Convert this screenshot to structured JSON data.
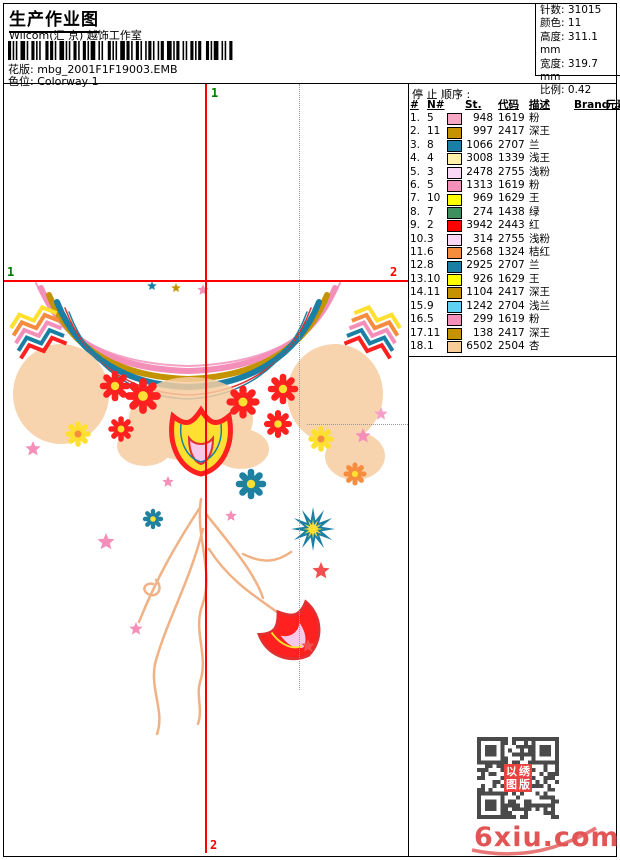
{
  "header": {
    "title": "生产作业图",
    "subtitle": "Wilcom(汇 京) 越饰工作室",
    "design_label": "花版:",
    "design_value": "mbg_2001F1F19003.EMB",
    "colorway_label": "色位:",
    "colorway_value": "Colorway 1"
  },
  "info_box": {
    "rows": [
      {
        "label": "针数:",
        "value": "31015"
      },
      {
        "label": "颜色:",
        "value": "11"
      },
      {
        "label": "高度:",
        "value": "311.1 mm"
      },
      {
        "label": "宽度:",
        "value": "319.7 mm"
      },
      {
        "label": "比例:",
        "value": "0.42"
      }
    ]
  },
  "stop_sequence": {
    "title": "停 止 顺序 :",
    "columns": [
      "#",
      "N#",
      "St.",
      "代码",
      "描述",
      "Brand",
      "元素"
    ],
    "rows": [
      {
        "idx": "1.",
        "needle": "5",
        "color": "#F7A8C4",
        "st": "948",
        "code": "1619",
        "desc": "粉"
      },
      {
        "idx": "2.",
        "needle": "11",
        "color": "#C49300",
        "st": "997",
        "code": "2417",
        "desc": "深王"
      },
      {
        "idx": "3.",
        "needle": "8",
        "color": "#1B7FA4",
        "st": "1066",
        "code": "2707",
        "desc": "兰"
      },
      {
        "idx": "4.",
        "needle": "4",
        "color": "#FFF2A8",
        "st": "3008",
        "code": "1339",
        "desc": "浅王"
      },
      {
        "idx": "5.",
        "needle": "3",
        "color": "#FAD7F5",
        "st": "2478",
        "code": "2755",
        "desc": "浅粉"
      },
      {
        "idx": "6.",
        "needle": "5",
        "color": "#F48FB9",
        "st": "1313",
        "code": "1619",
        "desc": "粉"
      },
      {
        "idx": "7.",
        "needle": "10",
        "color": "#FFFF00",
        "st": "969",
        "code": "1629",
        "desc": "王"
      },
      {
        "idx": "8.",
        "needle": "7",
        "color": "#3F8F5F",
        "st": "274",
        "code": "1438",
        "desc": "绿"
      },
      {
        "idx": "9.",
        "needle": "2",
        "color": "#FF0000",
        "st": "3942",
        "code": "2443",
        "desc": "红"
      },
      {
        "idx": "10.",
        "needle": "3",
        "color": "#FAD7F5",
        "st": "314",
        "code": "2755",
        "desc": "浅粉"
      },
      {
        "idx": "11.",
        "needle": "6",
        "color": "#F68C3E",
        "st": "2568",
        "code": "1324",
        "desc": "桔红"
      },
      {
        "idx": "12.",
        "needle": "8",
        "color": "#1B7FA4",
        "st": "2925",
        "code": "2707",
        "desc": "兰"
      },
      {
        "idx": "13.",
        "needle": "10",
        "color": "#FFFF00",
        "st": "926",
        "code": "1629",
        "desc": "王"
      },
      {
        "idx": "14.",
        "needle": "11",
        "color": "#C49300",
        "st": "1104",
        "code": "2417",
        "desc": "深王"
      },
      {
        "idx": "15.",
        "needle": "9",
        "color": "#5FD2F2",
        "st": "1242",
        "code": "2704",
        "desc": "浅兰"
      },
      {
        "idx": "16.",
        "needle": "5",
        "color": "#F48FB9",
        "st": "299",
        "code": "1619",
        "desc": "粉"
      },
      {
        "idx": "17.",
        "needle": "11",
        "color": "#C49300",
        "st": "138",
        "code": "2417",
        "desc": "深王"
      },
      {
        "idx": "18.",
        "needle": "1",
        "color": "#F8CB9B",
        "st": "6502",
        "code": "2504",
        "desc": "杏"
      }
    ]
  },
  "design_area": {
    "start_label": "1",
    "end_label": "2",
    "start_color": "#007A00",
    "end_color": "#FF0000"
  },
  "watermark": {
    "site": "6xiu.com",
    "seal_chars": [
      "以",
      "绣",
      "图",
      "版"
    ],
    "color": "#E25555"
  }
}
